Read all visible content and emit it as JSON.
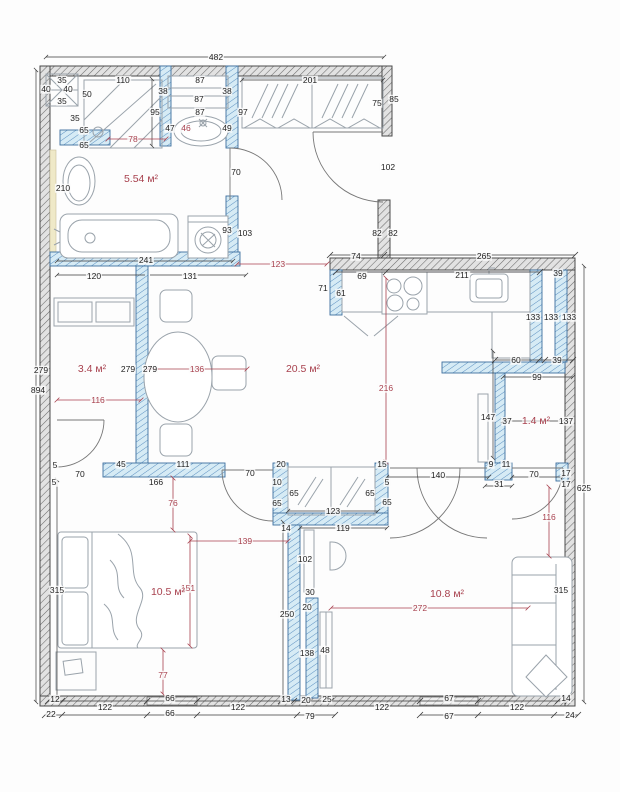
{
  "title": "Apartment floor plan with dimensions",
  "units": "cm",
  "colors": {
    "wall_interior_hatch": "#d6ebf5",
    "wall_interior_line": "#3d6f9e",
    "wall_exterior_hatch": "#e2e2e2",
    "wall_exterior_line": "#4a4a4a",
    "dimension_text": "#222222",
    "dimension_red": "#a8414e",
    "furniture_line": "#9aa3ab",
    "accent_strip": "#efe9c8"
  },
  "overall_dimensions": {
    "top": "482",
    "left": "894",
    "right": "625"
  },
  "rooms": [
    {
      "id": "bathroom",
      "area": "5.54 м²",
      "x": 141,
      "y": 179
    },
    {
      "id": "wardrobe-room",
      "area": "3.4 м²",
      "x": 92,
      "y": 369
    },
    {
      "id": "living-kitchen",
      "area": "20.5 м²",
      "x": 303,
      "y": 369
    },
    {
      "id": "pantry",
      "area": "1.4 м²",
      "x": 536,
      "y": 421
    },
    {
      "id": "bedroom",
      "area": "10.5 м²",
      "x": 168,
      "y": 592
    },
    {
      "id": "living-room",
      "area": "10.8 м²",
      "x": 447,
      "y": 594
    }
  ],
  "labels": [
    {
      "t": "482",
      "x": 216,
      "y": 57
    },
    {
      "t": "35",
      "x": 62,
      "y": 80
    },
    {
      "t": "110",
      "x": 123,
      "y": 80
    },
    {
      "t": "87",
      "x": 200,
      "y": 80
    },
    {
      "t": "40",
      "x": 46,
      "y": 89
    },
    {
      "t": "40",
      "x": 68,
      "y": 89
    },
    {
      "t": "38",
      "x": 163,
      "y": 91
    },
    {
      "t": "38",
      "x": 227,
      "y": 91
    },
    {
      "t": "50",
      "x": 87,
      "y": 94
    },
    {
      "t": "87",
      "x": 199,
      "y": 99
    },
    {
      "t": "35",
      "x": 62,
      "y": 101
    },
    {
      "t": "95",
      "x": 155,
      "y": 112
    },
    {
      "t": "87",
      "x": 200,
      "y": 112
    },
    {
      "t": "97",
      "x": 243,
      "y": 112
    },
    {
      "t": "35",
      "x": 75,
      "y": 118
    },
    {
      "t": "201",
      "x": 310,
      "y": 80
    },
    {
      "t": "75",
      "x": 377,
      "y": 103
    },
    {
      "t": "85",
      "x": 394,
      "y": 99
    },
    {
      "t": "65",
      "x": 84,
      "y": 130
    },
    {
      "t": "47",
      "x": 170,
      "y": 128
    },
    {
      "t": "46",
      "x": 186,
      "y": 128,
      "r": 1
    },
    {
      "t": "49",
      "x": 227,
      "y": 128
    },
    {
      "t": "78",
      "x": 133,
      "y": 139,
      "r": 1
    },
    {
      "t": "65",
      "x": 84,
      "y": 145
    },
    {
      "t": "70",
      "x": 236,
      "y": 172
    },
    {
      "t": "102",
      "x": 388,
      "y": 167
    },
    {
      "t": "210",
      "x": 63,
      "y": 188
    },
    {
      "t": "93",
      "x": 227,
      "y": 230
    },
    {
      "t": "103",
      "x": 245,
      "y": 233
    },
    {
      "t": "82",
      "x": 377,
      "y": 233
    },
    {
      "t": "82",
      "x": 393,
      "y": 233
    },
    {
      "t": "241",
      "x": 146,
      "y": 260
    },
    {
      "t": "123",
      "x": 278,
      "y": 264,
      "r": 1
    },
    {
      "t": "74",
      "x": 356,
      "y": 256
    },
    {
      "t": "265",
      "x": 484,
      "y": 256
    },
    {
      "t": "120",
      "x": 94,
      "y": 276
    },
    {
      "t": "131",
      "x": 190,
      "y": 276
    },
    {
      "t": "69",
      "x": 362,
      "y": 276
    },
    {
      "t": "211",
      "x": 462,
      "y": 275
    },
    {
      "t": "39",
      "x": 558,
      "y": 273
    },
    {
      "t": "71",
      "x": 323,
      "y": 288
    },
    {
      "t": "61",
      "x": 341,
      "y": 293
    },
    {
      "t": "133",
      "x": 533,
      "y": 317
    },
    {
      "t": "133",
      "x": 551,
      "y": 317
    },
    {
      "t": "133",
      "x": 569,
      "y": 317
    },
    {
      "t": "894",
      "x": 38,
      "y": 390
    },
    {
      "t": "279",
      "x": 41,
      "y": 370
    },
    {
      "t": "279",
      "x": 128,
      "y": 369
    },
    {
      "t": "279",
      "x": 150,
      "y": 369
    },
    {
      "t": "136",
      "x": 197,
      "y": 369,
      "r": 1
    },
    {
      "t": "116",
      "x": 98,
      "y": 400,
      "r": 1
    },
    {
      "t": "216",
      "x": 386,
      "y": 388,
      "r": 1
    },
    {
      "t": "60",
      "x": 516,
      "y": 360
    },
    {
      "t": "39",
      "x": 557,
      "y": 360
    },
    {
      "t": "99",
      "x": 537,
      "y": 377
    },
    {
      "t": "147",
      "x": 488,
      "y": 417
    },
    {
      "t": "37",
      "x": 507,
      "y": 421
    },
    {
      "t": "137",
      "x": 566,
      "y": 421
    },
    {
      "t": "45",
      "x": 121,
      "y": 464
    },
    {
      "t": "111",
      "x": 183,
      "y": 464
    },
    {
      "t": "5",
      "x": 55,
      "y": 465
    },
    {
      "t": "5",
      "x": 54,
      "y": 482
    },
    {
      "t": "70",
      "x": 80,
      "y": 474
    },
    {
      "t": "70",
      "x": 250,
      "y": 473
    },
    {
      "t": "166",
      "x": 156,
      "y": 482
    },
    {
      "t": "20",
      "x": 281,
      "y": 464
    },
    {
      "t": "10",
      "x": 277,
      "y": 482
    },
    {
      "t": "15",
      "x": 382,
      "y": 464
    },
    {
      "t": "5",
      "x": 387,
      "y": 482
    },
    {
      "t": "65",
      "x": 294,
      "y": 493
    },
    {
      "t": "65",
      "x": 370,
      "y": 493
    },
    {
      "t": "65",
      "x": 277,
      "y": 503
    },
    {
      "t": "65",
      "x": 387,
      "y": 502
    },
    {
      "t": "123",
      "x": 333,
      "y": 511
    },
    {
      "t": "14",
      "x": 286,
      "y": 528
    },
    {
      "t": "119",
      "x": 343,
      "y": 528
    },
    {
      "t": "140",
      "x": 438,
      "y": 475
    },
    {
      "t": "9",
      "x": 491,
      "y": 464
    },
    {
      "t": "11",
      "x": 506,
      "y": 464
    },
    {
      "t": "31",
      "x": 499,
      "y": 484
    },
    {
      "t": "70",
      "x": 534,
      "y": 474
    },
    {
      "t": "17",
      "x": 566,
      "y": 473
    },
    {
      "t": "17",
      "x": 566,
      "y": 484
    },
    {
      "t": "625",
      "x": 584,
      "y": 488
    },
    {
      "t": "116",
      "x": 549,
      "y": 517,
      "r": 1
    },
    {
      "t": "76",
      "x": 173,
      "y": 503,
      "r": 1
    },
    {
      "t": "139",
      "x": 245,
      "y": 541,
      "r": 1
    },
    {
      "t": "102",
      "x": 305,
      "y": 559
    },
    {
      "t": "315",
      "x": 57,
      "y": 590
    },
    {
      "t": "151",
      "x": 188,
      "y": 588,
      "r": 1
    },
    {
      "t": "315",
      "x": 561,
      "y": 590
    },
    {
      "t": "30",
      "x": 310,
      "y": 592
    },
    {
      "t": "20",
      "x": 307,
      "y": 607
    },
    {
      "t": "250",
      "x": 287,
      "y": 614
    },
    {
      "t": "272",
      "x": 420,
      "y": 608,
      "r": 1
    },
    {
      "t": "138",
      "x": 307,
      "y": 653
    },
    {
      "t": "48",
      "x": 325,
      "y": 650
    },
    {
      "t": "77",
      "x": 163,
      "y": 675,
      "r": 1
    },
    {
      "t": "12",
      "x": 55,
      "y": 699
    },
    {
      "t": "66",
      "x": 170,
      "y": 698
    },
    {
      "t": "122",
      "x": 105,
      "y": 707
    },
    {
      "t": "122",
      "x": 238,
      "y": 707
    },
    {
      "t": "13",
      "x": 286,
      "y": 699
    },
    {
      "t": "20",
      "x": 306,
      "y": 700
    },
    {
      "t": "25",
      "x": 327,
      "y": 699
    },
    {
      "t": "22",
      "x": 51,
      "y": 714
    },
    {
      "t": "66",
      "x": 170,
      "y": 713
    },
    {
      "t": "79",
      "x": 310,
      "y": 716
    },
    {
      "t": "67",
      "x": 449,
      "y": 698
    },
    {
      "t": "122",
      "x": 382,
      "y": 707
    },
    {
      "t": "122",
      "x": 517,
      "y": 707
    },
    {
      "t": "14",
      "x": 566,
      "y": 698
    },
    {
      "t": "67",
      "x": 449,
      "y": 716
    },
    {
      "t": "24",
      "x": 570,
      "y": 715
    }
  ]
}
